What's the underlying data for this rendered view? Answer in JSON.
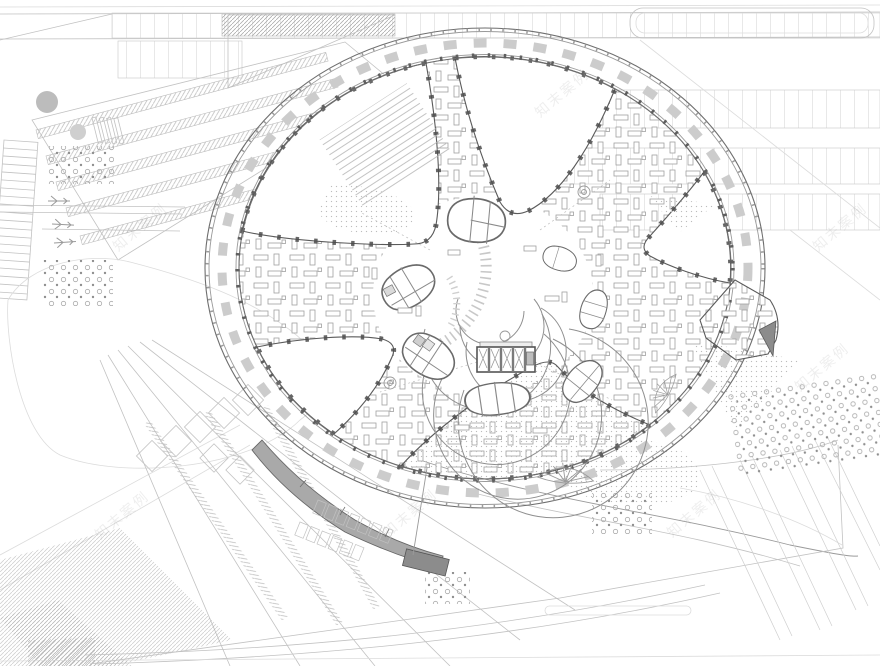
{
  "watermark": {
    "text": "知末案例"
  },
  "palette": {
    "paper": "#ffffff",
    "ink_dark": "#4c4c4c",
    "ink_mid": "#8f8f8f",
    "ink_light": "#b9b9b9",
    "ink_faint": "#d8d8d8",
    "ramp_fill": "#a9a9a9",
    "ramp_dark": "#8c8c8c",
    "gray_circle": "#bcbcbc",
    "stipple": "#bdbdbd",
    "watermark_color": "#9a9a9a"
  },
  "drawing": {
    "kind": "architectural floor / site plan",
    "subject": "circular ring office building with radial wings, central atrium, courtyard pods and landscaped site"
  }
}
